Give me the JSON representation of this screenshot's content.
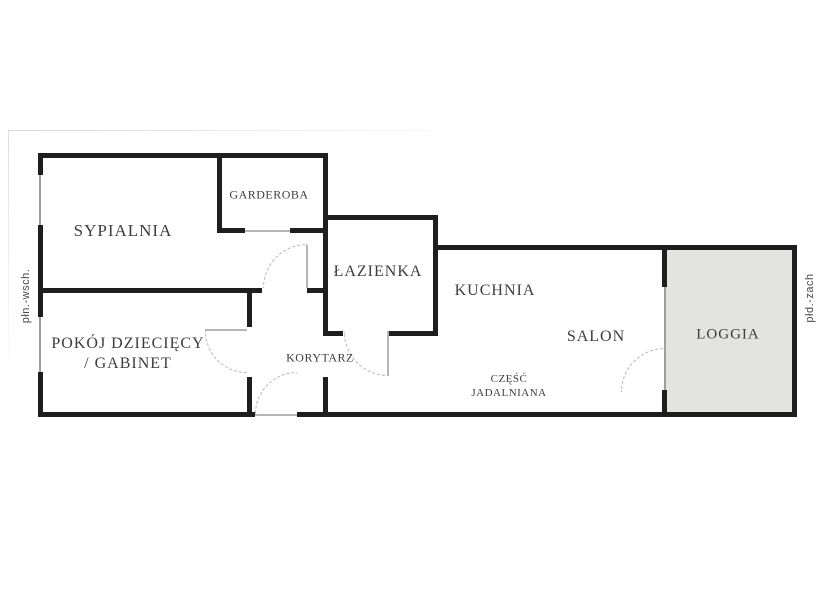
{
  "plan": {
    "type": "apartment-floor-plan",
    "rooms": {
      "sypialnia": {
        "label": "SYPIALNIA"
      },
      "garderoba": {
        "label": "GARDEROBA"
      },
      "lazienka": {
        "label": "ŁAZIENKA"
      },
      "kuchnia": {
        "label": "KUCHNIA"
      },
      "salon": {
        "label": "SALON"
      },
      "loggia": {
        "label": "LOGGIA"
      },
      "pokoj_dzieciecy": {
        "label_line1": "POKÓJ DZIECIĘCY",
        "label_line2": "/ GABINET"
      },
      "korytarz": {
        "label": "KORYTARZ"
      },
      "czesc_jadalniana": {
        "label_line1": "CZĘŚĆ",
        "label_line2": "JADALNIANA"
      }
    },
    "compass": {
      "left_label": "płn.-wsch.",
      "right_label": "płd.-zach"
    }
  },
  "colors": {
    "wall": "#1e1e1e",
    "text": "#3d3d3d",
    "compass-text": "#4a4a4a",
    "door": "#b5b5b5",
    "window": "#9e9e9e",
    "loggia-fill": "#e3e3e0",
    "watermark": "#dcdcdc"
  }
}
